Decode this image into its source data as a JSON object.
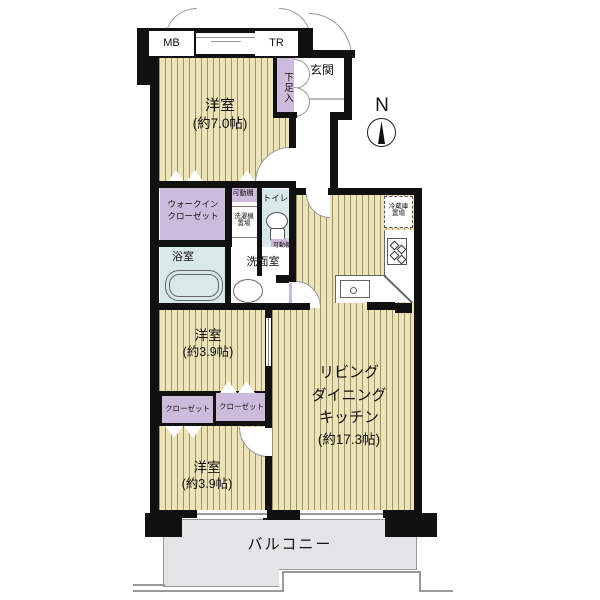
{
  "colors": {
    "wall": "#111111",
    "tatami": "#ece4b8",
    "stripe": "#9d9468",
    "purple": "#cdbbdb",
    "blue": "#d9e9e9",
    "bgray": "#e4e4e6",
    "line": "#999999"
  },
  "compass": {
    "label": "N"
  },
  "top": {
    "mb": "MB",
    "tr": "TR"
  },
  "entrance": {
    "label": "玄関",
    "shoe": "下足入"
  },
  "rooms": {
    "bedroom_top": {
      "name": "洋室",
      "size": "(約7.0帖)"
    },
    "wic": {
      "line1": "ウォークイン",
      "line2": "クローゼット"
    },
    "shelf_top": {
      "label": "可動棚"
    },
    "washer": {
      "line1": "洗濯機",
      "line2": "置場"
    },
    "toilet": {
      "label": "トイレ"
    },
    "shelf_side": {
      "label": "可動棚"
    },
    "bath": {
      "label": "浴室"
    },
    "washroom": {
      "label": "洗面室"
    },
    "fridge": {
      "line1": "冷蔵庫",
      "line2": "置場"
    },
    "ldk": {
      "line1": "リビング",
      "line2": "ダイニング",
      "line3": "キッチン",
      "size": "(約17.3帖)"
    },
    "bedroom_mid": {
      "name": "洋室",
      "size": "(約3.9帖)"
    },
    "closet_left": {
      "label": "クローゼット"
    },
    "closet_right": {
      "label": "クローゼット"
    },
    "bedroom_bottom": {
      "name": "洋室",
      "size": "(約3.9帖)"
    },
    "balcony": {
      "label": "バルコニー"
    }
  }
}
